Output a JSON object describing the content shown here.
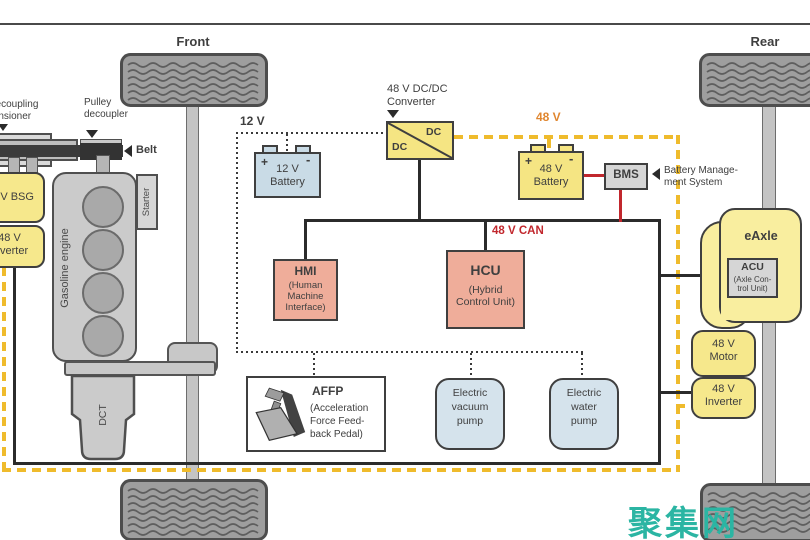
{
  "frame": {
    "front": "Front",
    "rear": "Rear"
  },
  "belt": {
    "tensioner": "decoupling\ntensioner",
    "pulley": "Pulley\ndecoupler",
    "belt": "Belt"
  },
  "engine": {
    "name": "Gasoline engine",
    "starter": "Starter",
    "dct": "DCT"
  },
  "bsg": {
    "label": "48 V BSG"
  },
  "bsg_inverter": {
    "label": "48 V\nInverter"
  },
  "net12": {
    "label": "12 V"
  },
  "batt12": {
    "plus": "+",
    "minus": "-",
    "label": "12 V\nBattery"
  },
  "dcdc": {
    "title": "48 V DC/DC\nConverter",
    "dc1": "DC",
    "dc2": "DC"
  },
  "net48": {
    "label": "48 V"
  },
  "batt48": {
    "plus": "+",
    "minus": "-",
    "label": "48 V\nBattery"
  },
  "bms": {
    "label": "BMS",
    "annotation": "Battery Manage-\nment System"
  },
  "can": {
    "label": "48 V CAN"
  },
  "hmi": {
    "title": "HMI",
    "sub": "(Human\nMachine\nInterface)"
  },
  "hcu": {
    "title": "HCU",
    "sub": "(Hybrid\nControl Unit)"
  },
  "affp": {
    "title": "AFFP",
    "sub": "(Acceleration\nForce Feed-\nback Pedal)"
  },
  "vacuum": {
    "label": "Electric\nvacuum\npump"
  },
  "water": {
    "label": "Electric\nwater\npump"
  },
  "eaxle": {
    "label": "eAxle",
    "acu": "ACU",
    "acu_sub": "(Axle Con-\ntrol Unit)"
  },
  "motor": {
    "label": "48 V\nMotor"
  },
  "inverter_rear": {
    "label": "48 V\nInverter"
  },
  "watermark": {
    "text": "聚集网"
  },
  "colors": {
    "yellow_48v_component": "#F5E583",
    "yellow_dash_48v_net": "#EFBB2C",
    "blue_12v_battery": "#C9DBE6",
    "blue_pump": "#D5E3EC",
    "salmon_control_unit": "#EFAD9A",
    "gray_module": "#D6D6D6",
    "red_power_line": "#C1272D",
    "orange_48v_label": "#E0862F",
    "watermark_teal": "#2BB5A3"
  }
}
